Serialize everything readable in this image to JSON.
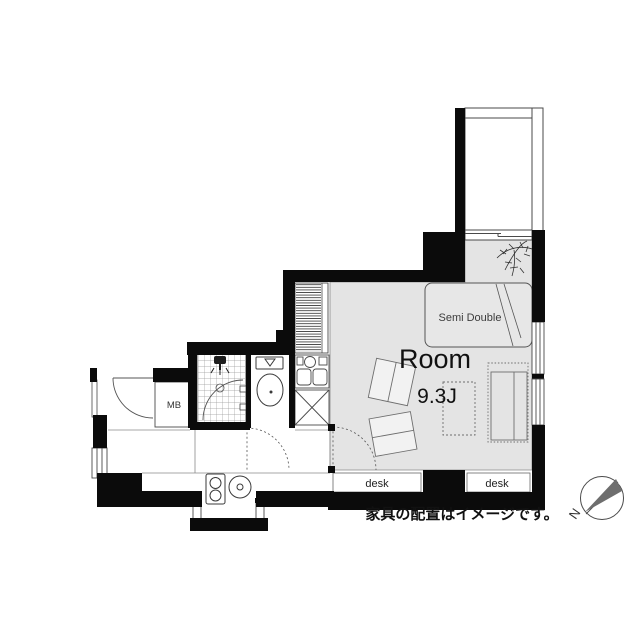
{
  "floorplan": {
    "room": {
      "label": "Room",
      "size_label": "9.3J"
    },
    "furniture": {
      "bed_label": "Semi Double",
      "desk_left_label": "desk",
      "desk_right_label": "desk"
    },
    "utility": {
      "meter_box_label": "MB"
    },
    "caption": "家具の配置はイメージです。",
    "compass": {
      "north_label": "N"
    },
    "colors": {
      "wall": "#0b0b0b",
      "room_fill": "#e4e4e4",
      "line": "#4a4a4a",
      "compass_needle": "#6e6e6e"
    }
  }
}
